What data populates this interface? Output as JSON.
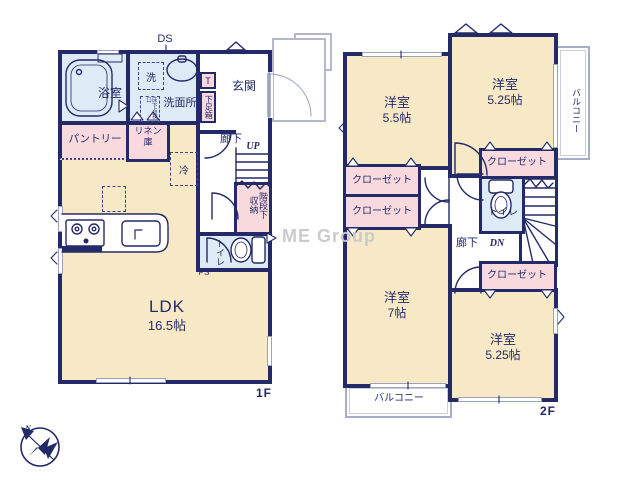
{
  "floor1": {
    "label": "1F",
    "ds": "DS",
    "bath": "浴室",
    "washer": "洗",
    "washroom": "洗面所",
    "floor_hatch": "床下点検口",
    "shoe_t": "T",
    "shoe_box": "下足箱",
    "entrance": "玄関",
    "hallway": "廊下",
    "up": "UP",
    "under_stair_storage": "階段下収納",
    "pantry": "パントリー",
    "linen": "リネン庫",
    "fridge": "冷",
    "toilet": "トイレ",
    "ps": "PS",
    "ldk": "LDK",
    "ldk_size": "16.5帖"
  },
  "floor2": {
    "label": "2F",
    "hallway": "廊下",
    "dn": "DN",
    "toilet": "トイレ",
    "balcony_right": "バルコニー",
    "balcony_bottom": "バルコニー",
    "rooms": [
      {
        "name": "洋室",
        "size": "5.5帖"
      },
      {
        "name": "洋室",
        "size": "5.25帖"
      },
      {
        "name": "洋室",
        "size": "7帖"
      },
      {
        "name": "洋室",
        "size": "5.25帖"
      }
    ],
    "closets": [
      "クローゼット",
      "クローゼット",
      "クローゼット",
      "クローゼット"
    ]
  },
  "compass": {
    "n": "N"
  },
  "watermark": "ME Group",
  "colors": {
    "wall": "#242a68",
    "room": "#f7e9c6",
    "wet": "#dcebf5",
    "storage": "#f8d9de"
  }
}
